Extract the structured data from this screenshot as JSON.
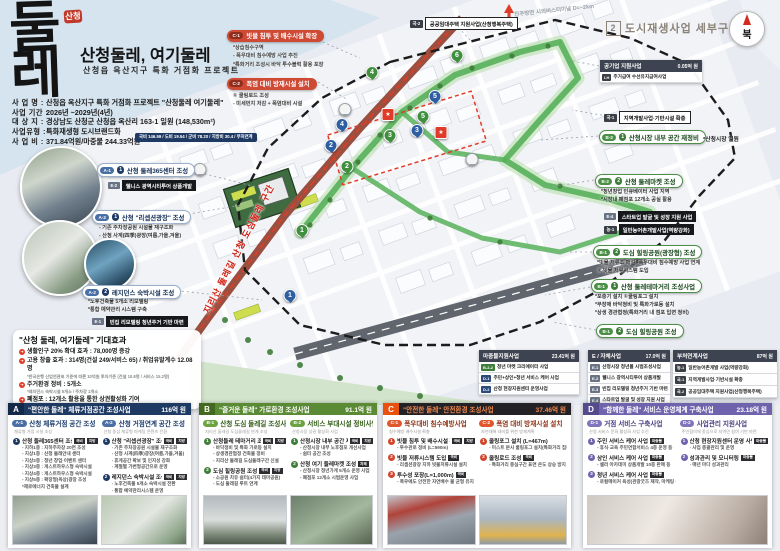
{
  "colors": {
    "navy": "#1e3a63",
    "green": "#5a8a33",
    "orange": "#e8500e",
    "purple": "#6f63ad",
    "accent_red": "#e03b28"
  },
  "icons": {
    "effect_arrow": "➜"
  },
  "logo": {
    "stamp": "산청",
    "calligraphy": "둘레",
    "title": "산청둘레, 여기둘레",
    "subtitle": "산청읍 옥산지구 특화 거점화 프로젝트"
  },
  "info": {
    "rows": [
      {
        "label": "사 업 명",
        "value": "산청읍 옥산지구 특화 거점화 프로젝트 \"산청둘레 여기둘레\""
      },
      {
        "label": "사업 기간",
        "value": "2026년 ~2029년(4년)"
      },
      {
        "label": "대 상 지",
        "value": "경상남도 산청군 산청읍 옥산리 163-1 일원 (148,530m²)"
      },
      {
        "label": "사업유형",
        "value": "특화재생형  도시브랜드화"
      },
      {
        "label": "사 업 비",
        "value": "371.84억원/마중물 244.33억원"
      }
    ],
    "budget_badge": "국비 146.59 / 도비 19.54 / 군비 78.20 / 지방비 30.4 / 부처연계"
  },
  "map": {
    "section_no": "2",
    "section_title": "도시재생사업 세부구상도",
    "compass_label": "북",
    "road_label": "지리산 둘레길 산청 도심둘레 구간",
    "dist_label": "진주방면 시외버스터미널 D=~2km",
    "markers": [
      {
        "n": "1",
        "c": "g",
        "x": 302,
        "y": 237
      },
      {
        "n": "2",
        "c": "g",
        "x": 347,
        "y": 173
      },
      {
        "n": "3",
        "c": "g",
        "x": 390,
        "y": 142
      },
      {
        "n": "4",
        "c": "g",
        "x": 372,
        "y": 79
      },
      {
        "n": "5",
        "c": "g",
        "x": 423,
        "y": 123
      },
      {
        "n": "6",
        "c": "g",
        "x": 457,
        "y": 62
      },
      {
        "n": "1",
        "c": "b",
        "x": 290,
        "y": 302
      },
      {
        "n": "2",
        "c": "b",
        "x": 331,
        "y": 152
      },
      {
        "n": "3",
        "c": "b",
        "x": 417,
        "y": 137
      },
      {
        "n": "4",
        "c": "b",
        "x": 342,
        "y": 131
      },
      {
        "n": "5",
        "c": "b",
        "x": 435,
        "y": 103
      },
      {
        "n": "★",
        "c": "r",
        "x": 388,
        "y": 121
      },
      {
        "n": "★",
        "c": "r",
        "x": 441,
        "y": 139
      },
      {
        "n": "",
        "c": "w",
        "x": 345,
        "y": 116
      },
      {
        "n": "",
        "c": "w",
        "x": 472,
        "y": 166
      },
      {
        "n": "",
        "c": "w",
        "x": 200,
        "y": 176
      }
    ]
  },
  "left_callouts": [
    {
      "code": "A-1",
      "num": "1",
      "title": "산청 둘레365센터 조성",
      "sub": {
        "code": "E-2",
        "text": "웰니스 광역시티투어 상품개발"
      }
    },
    {
      "code": "A-2",
      "num": "1",
      "title": "산청 \"리셉션광장\" 조성",
      "bullets": [
        "- 기존 주차장공원 시설물 재구조화",
        "- 산청 사계(四季)광장(여름,가을,겨울)"
      ]
    },
    {
      "code": "A-2",
      "num": "2",
      "title": "레지던스 숙박시설 조성",
      "bullets": [
        "*노후건축물 5개소 리모델링",
        "*통합 예약관리 시스템 구축"
      ],
      "sub": {
        "code": "E-1",
        "text": "빈집 리모델링 청년주거 기반 마련"
      }
    }
  ],
  "top_callouts": [
    {
      "code": "C-1",
      "title": "빗물 침투 및 배수시설 확장",
      "bullets": [
        "*상습침수구역",
        "- 폭우대비 침수예방 사업 추진",
        "*특화거리 조성시 바닥 투수블럭 활용 포장"
      ]
    },
    {
      "code": "C-2",
      "title": "폭염 대비 방재시설 설치",
      "bullets": [
        "① 쿨링로드 조성",
        "- 미세먼지 저감 + 폭염대비 시설"
      ]
    }
  ],
  "right_callouts": [
    {
      "code": "국-2",
      "text": "공공임대주택 지원사업(산청행복주택)"
    },
    {
      "code": "국-1",
      "text": "지역개발사업·기반시설 확충"
    },
    {
      "code": "B-2",
      "num": "1",
      "title": "산청시장 내부 공간 재정비",
      "side": "*산청시장 일원"
    },
    {
      "code": "B-2",
      "num": "2",
      "title": "산청 둘레마켓 조성",
      "bullets": [
        "*청년창업 인큐베이터 사업 지역",
        "*시장내 폐점포 12개소 공실 활용"
      ]
    },
    {
      "code": "E-4",
      "text": "스타트업 발굴 및 성장 지원 사업"
    },
    {
      "code": "농-1",
      "text": "일반농어촌개발사업(역량강화)"
    },
    {
      "code": "B-1",
      "num": "2",
      "title": "도심 힐링공원(광장형) 조성",
      "bullets": [
        "*빗물 저류조 매설 -폭우대비 침수예방 사업 연계",
        "② 빗물 저류시스템 도입"
      ]
    },
    {
      "code": "B-1",
      "num": "1",
      "title": "산청 둘레테마거리 조성사업",
      "bullets": [
        "*포충기 설치 ①쿨링포그 설치",
        "*무장애 바닥정비 및 특화가로등 설치",
        "*상생 경관협정(특화거리 내 점포 입면 정비)"
      ]
    },
    {
      "code": "B-1",
      "num": "2",
      "title": "도심 힐링공원 조성"
    }
  ],
  "effects": {
    "title": "\"산청 둘레, 여기둘레\" 기대효과",
    "items": [
      {
        "text": "생활인구 20% 확대 효과 : 78,000명 증강",
        "note": ""
      },
      {
        "text": "고용 창출 효과 : 314명(건설 249/서비스 65) / 취업유발계수 12.08명",
        "note": "*한국은행 산업연관표 기준에 따른 10억원 투자기준 (건설 10.8명 / 서비스 15.2명)"
      },
      {
        "text": "주거환경 정비 : 5개소",
        "note": "*레지던스 숙박시설 5개소 / 주차장 1개소"
      },
      {
        "text": "폐점포 : 12개소 활용을 통한 상권활성화 기여",
        "note": ""
      }
    ]
  },
  "tables": [
    {
      "title": "마중물지원사업",
      "amount": "23.41억 원",
      "rows": [
        {
          "tag": "B-2-2",
          "k": "g",
          "text": "청년 마켓 크리에이터 사업"
        },
        {
          "tag": "D-1",
          "k": "n",
          "text": "주민+상인+청년 서비스 케어 사업"
        },
        {
          "tag": "D-2",
          "k": "n",
          "text": "산청 현장지원센터 운영사업"
        }
      ]
    },
    {
      "title": "E / 자체사업",
      "amount": "17.0억 원",
      "rows": [
        {
          "tag": "E-1",
          "k": "e",
          "text": "산청시장 청년몰 시범조성사업"
        },
        {
          "tag": "E-2",
          "k": "e",
          "text": "웰니스 광역시티투어 상품개발"
        },
        {
          "tag": "E-3",
          "k": "e",
          "text": "빈집 리모델링 청년주거 기반 마련"
        },
        {
          "tag": "E-4",
          "k": "e",
          "text": "스타트업 발굴 및 성장 지원 사업"
        }
      ]
    },
    {
      "title": "부처연계사업",
      "amount": "87억 원",
      "rows": [
        {
          "tag": "농-1",
          "k": "d",
          "text": "일반농어촌개발 사업(역량강화)"
        },
        {
          "tag": "국-1",
          "k": "d",
          "text": "지역개발사업·기반시설 확충"
        },
        {
          "tag": "국-2",
          "k": "d",
          "text": "공공임대주택 지원사업(산청행복주택)"
        }
      ]
    },
    {
      "title": "공기업 지원사업",
      "amount": "0.05억 원",
      "rows": [
        {
          "tag": "LH",
          "k": "d",
          "text": "주거급여 수선유지급여사업"
        }
      ]
    }
  ],
  "panels": [
    {
      "letter": "A",
      "title": "\"편안한 둘레\" 체류거점공간 조성사업",
      "amount": "116억 원",
      "groups": [
        {
          "code": "A-1",
          "name": "산청 체류거점 공간 조성",
          "sub": "체류형 거점 시설 조성",
          "items": [
            {
              "num": "1",
              "title": "산청 둘레365센터 조성",
              "badges": [
                "국비",
                "지방"
              ],
              "bullets": [
                "- 지하1층 : 지하주차장 20면 조성",
                "- 지상1층 : 산청 둘레안내 센터",
                "- 지상2층 : 청년 창업·이벤트 센터",
                "- 지상3층 : 게스트하우스형 숙박시설",
                "- 지상4층 : 게스트하우스형 숙박시설",
                "- 지상5층 : 확장형(옥상)광장 조성",
                "*제로에너지 건축물 설계"
              ]
            }
          ]
        },
        {
          "code": "A-2",
          "name": "산청 거점연계 공간 조성",
          "sub": "산청 중심 체류형 마케팅 콘텐츠 전환",
          "items": [
            {
              "num": "1",
              "title": "산청 \"리셉션광장\" 조성",
              "badges": [
                "국비",
                "지방"
              ],
              "bullets": [
                "- 기존 주차장공원 시설물 재구조화",
                "- 산청 사계(四季)광장(여름,가을,겨울)",
                "- 휴게공간 확보 및 인지성 강화",
                "- 계절별 가변형공간으로 운영"
              ]
            },
            {
              "num": "2",
              "title": "레지던스 숙박시설 조성",
              "badges": [
                "국비",
                "지방"
              ],
              "bullets": [
                "- 노후건축물 5개소 숙박시설 전환",
                "- 통합 예약관리시스템 운영"
              ]
            }
          ]
        }
      ]
    },
    {
      "letter": "B",
      "title": "\"즐거운 둘레\" 가로환경 조성사업",
      "amount": "91.1억 원",
      "groups": [
        {
          "code": "B-1",
          "name": "산청 도심 둘레길 조성사업",
          "sub": "지리산 둘레길 도심둘레길 연계 조성",
          "items": [
            {
              "num": "1",
              "title": "산청둘레 테마거리 조성사업",
              "badges": [
                "국비",
                "지방"
              ],
              "bullets": [
                "- 바닥정비 및 특화 가로등 설치",
                "- 상생경관협정 건축물 정비",
                "- 지리산 둘레길 도심둘레구간 신설"
              ]
            },
            {
              "num": "2",
              "title": "도심 힐링공원 조성",
              "badges": [
                "국비",
                "지방"
              ],
              "bullets": [
                "- 소공원 치유 쉼터(4가지 테마공원)",
                "- 도심 둘레길 루트 연계"
              ]
            }
          ]
        },
        {
          "code": "B-2",
          "name": "서비스 부대시설 정비사업",
          "sub": "산청시장 상권 활성화 사업",
          "items": [
            {
              "num": "1",
              "title": "산청시장 내부 공간 재정비",
              "badges": [
                "국비",
                "지방"
              ],
              "bullets": [
                "- 산청시장 내부 노후점포 개선사업",
                "- 쉼터 공간 조성"
              ]
            },
            {
              "num": "2",
              "title": "산청 여기 둘레마켓 조성",
              "badges": [
                "자체"
              ],
              "bullets": [
                "- 산청시장 청년가게 5개소 운영 사업",
                "- 폐점포 12개소 시범운영 사업"
              ]
            }
          ]
        }
      ]
    },
    {
      "letter": "C",
      "title": "\"안전한 둘레\" 안전환경 조성사업",
      "amount": "37.46억 원",
      "groups": [
        {
          "code": "C-1",
          "name": "폭우대비 침수예방사업",
          "sub": "침수예방 배수시설 확충",
          "items": [
            {
              "num": "1",
              "title": "빗물 침투 및 배수시설 확장",
              "badges": [
                "국비",
                "지방"
              ],
              "bullets": [
                "- 투수관로 정비 (L=590m)"
              ]
            },
            {
              "num": "2",
              "title": "빗물 저류시스템 도입",
              "badges": [
                "국비"
              ],
              "bullets": [
                "- 리셉션광장 지하 빗물저류시설 설치"
              ]
            },
            {
              "num": "3",
              "title": "투수성 포장(L=1,000m)",
              "badges": [
                "국비"
              ],
              "bullets": [
                "- 폭우에도 안전한 자연배수 물 균형 유지"
              ]
            }
          ]
        },
        {
          "code": "C-2",
          "name": "폭염 대비 방재시설 설치",
          "sub": "자연재해 대비를 위한 방재계획",
          "items": [
            {
              "num": "1",
              "title": "쿨링포그 설치 (L=467m)",
              "badges": [],
              "bullets": [
                "- 미스트 분사 쿨링포그 설치(특화거리 집중)"
              ]
            },
            {
              "num": "2",
              "title": "쿨링로드 조성",
              "badges": [
                "국비"
              ],
              "bullets": [
                "- 특화거리 중심구간 표면 온도 상승 방지"
              ]
            }
          ]
        }
      ]
    },
    {
      "letter": "D",
      "title": "\"함께한 둘레\" 서비스 운영체계 구축사업",
      "amount": "23.18억 원",
      "groups": [
        {
          "code": "D-1",
          "name": "거점 서비스 구축사업",
          "sub": "산청 서비스 문화 활성화 사업 추진",
          "items": [
            {
              "num": "1",
              "title": "주민 서비스 케어 사업",
              "badges": [
                "마중물"
              ],
              "bullets": [
                "- 휴식·교육 주민연합서비스 4종 운영 등"
              ]
            },
            {
              "num": "2",
              "title": "상인 서비스 케어 사업",
              "badges": [
                "마중물"
              ],
              "bullets": [
                "- 셀러 아카데미 상품개발 10종 판매 등"
              ]
            },
            {
              "num": "3",
              "title": "청년 서비스 케어 사업",
              "badges": [
                "마중물"
              ],
              "bullets": [
                "- 로컬메이커 육성(관광굿즈 제작, 마케팅 등)"
              ]
            }
          ]
        },
        {
          "code": "D-2",
          "name": "사업관리 지원사업",
          "sub": "주민협의체 중심으로 지역민 참여 기반 마련",
          "items": [
            {
              "num": "1",
              "title": "산청 현장지원센터 운영 사업",
              "badges": [
                "마중물"
              ],
              "bullets": [
                "- 사업 총괄관리 및 운영"
              ]
            },
            {
              "num": "2",
              "title": "성과관리 및 모니터링",
              "badges": [
                "마중물"
              ],
              "bullets": [
                "- 매년 마다 성과관리"
              ]
            }
          ]
        }
      ]
    }
  ]
}
